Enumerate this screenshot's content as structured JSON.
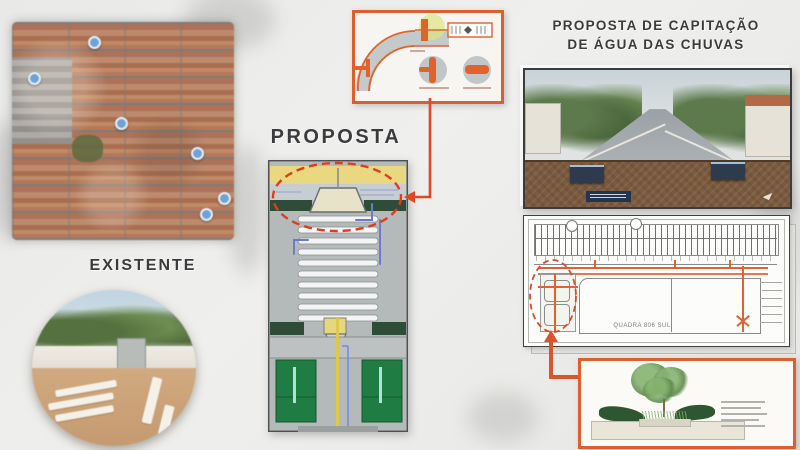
{
  "labels": {
    "existing": "EXISTENTE",
    "proposal": "PROPOSTA",
    "title_line1": "PROPOSTA DE CAPITAÇÃO",
    "title_line2": "DE ÁGUA DAS CHUVAS"
  },
  "right_plan": {
    "block_label": "QUADRA 806 SUL"
  },
  "icons": {
    "map_marker": "map-marker-icon"
  },
  "colors": {
    "callout_orange": "#dd5f2c",
    "connector_red": "#e0481f",
    "dashed_red": "#e23b1e",
    "plan_green": "#1f7c42",
    "plan_dark_green": "#2e4d39",
    "plan_yellow": "#e9d87f",
    "pipe_blue": "#6b79cf",
    "title_text": "#3b3b3d",
    "soil_brown": "#7b5b3f"
  }
}
